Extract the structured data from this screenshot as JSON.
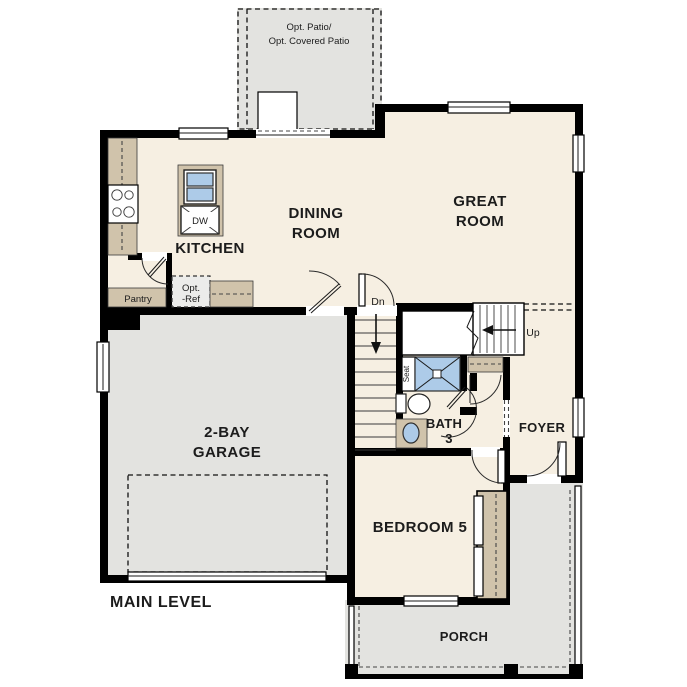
{
  "plan": {
    "title": "MAIN LEVEL",
    "rooms": {
      "patio": {
        "line1": "Opt. Patio/",
        "line2": "Opt. Covered Patio"
      },
      "kitchen": {
        "label": "KITCHEN"
      },
      "dining_room": {
        "line1": "DINING",
        "line2": "ROOM"
      },
      "great_room": {
        "line1": "GREAT",
        "line2": "ROOM"
      },
      "garage": {
        "line1": "2-BAY",
        "line2": "GARAGE"
      },
      "bath": {
        "line1": "BATH",
        "line2": "3"
      },
      "foyer": {
        "label": "FOYER"
      },
      "bedroom": {
        "label": "BEDROOM 5"
      },
      "porch": {
        "label": "PORCH"
      },
      "pantry": {
        "label": "Pantry"
      },
      "opt_ref": {
        "line1": "Opt.",
        "line2": "-Ref"
      }
    },
    "fixtures": {
      "dishwasher": "DW",
      "shower_seat": "Seat"
    },
    "stairs": {
      "down": "Dn",
      "up": "Up"
    },
    "colors": {
      "floor": "#f6efe2",
      "concrete": "#e3e3e0",
      "counter": "#d0c3ab",
      "water": "#adcbe8",
      "wall": "#000000",
      "text": "#1c1c1c"
    }
  }
}
